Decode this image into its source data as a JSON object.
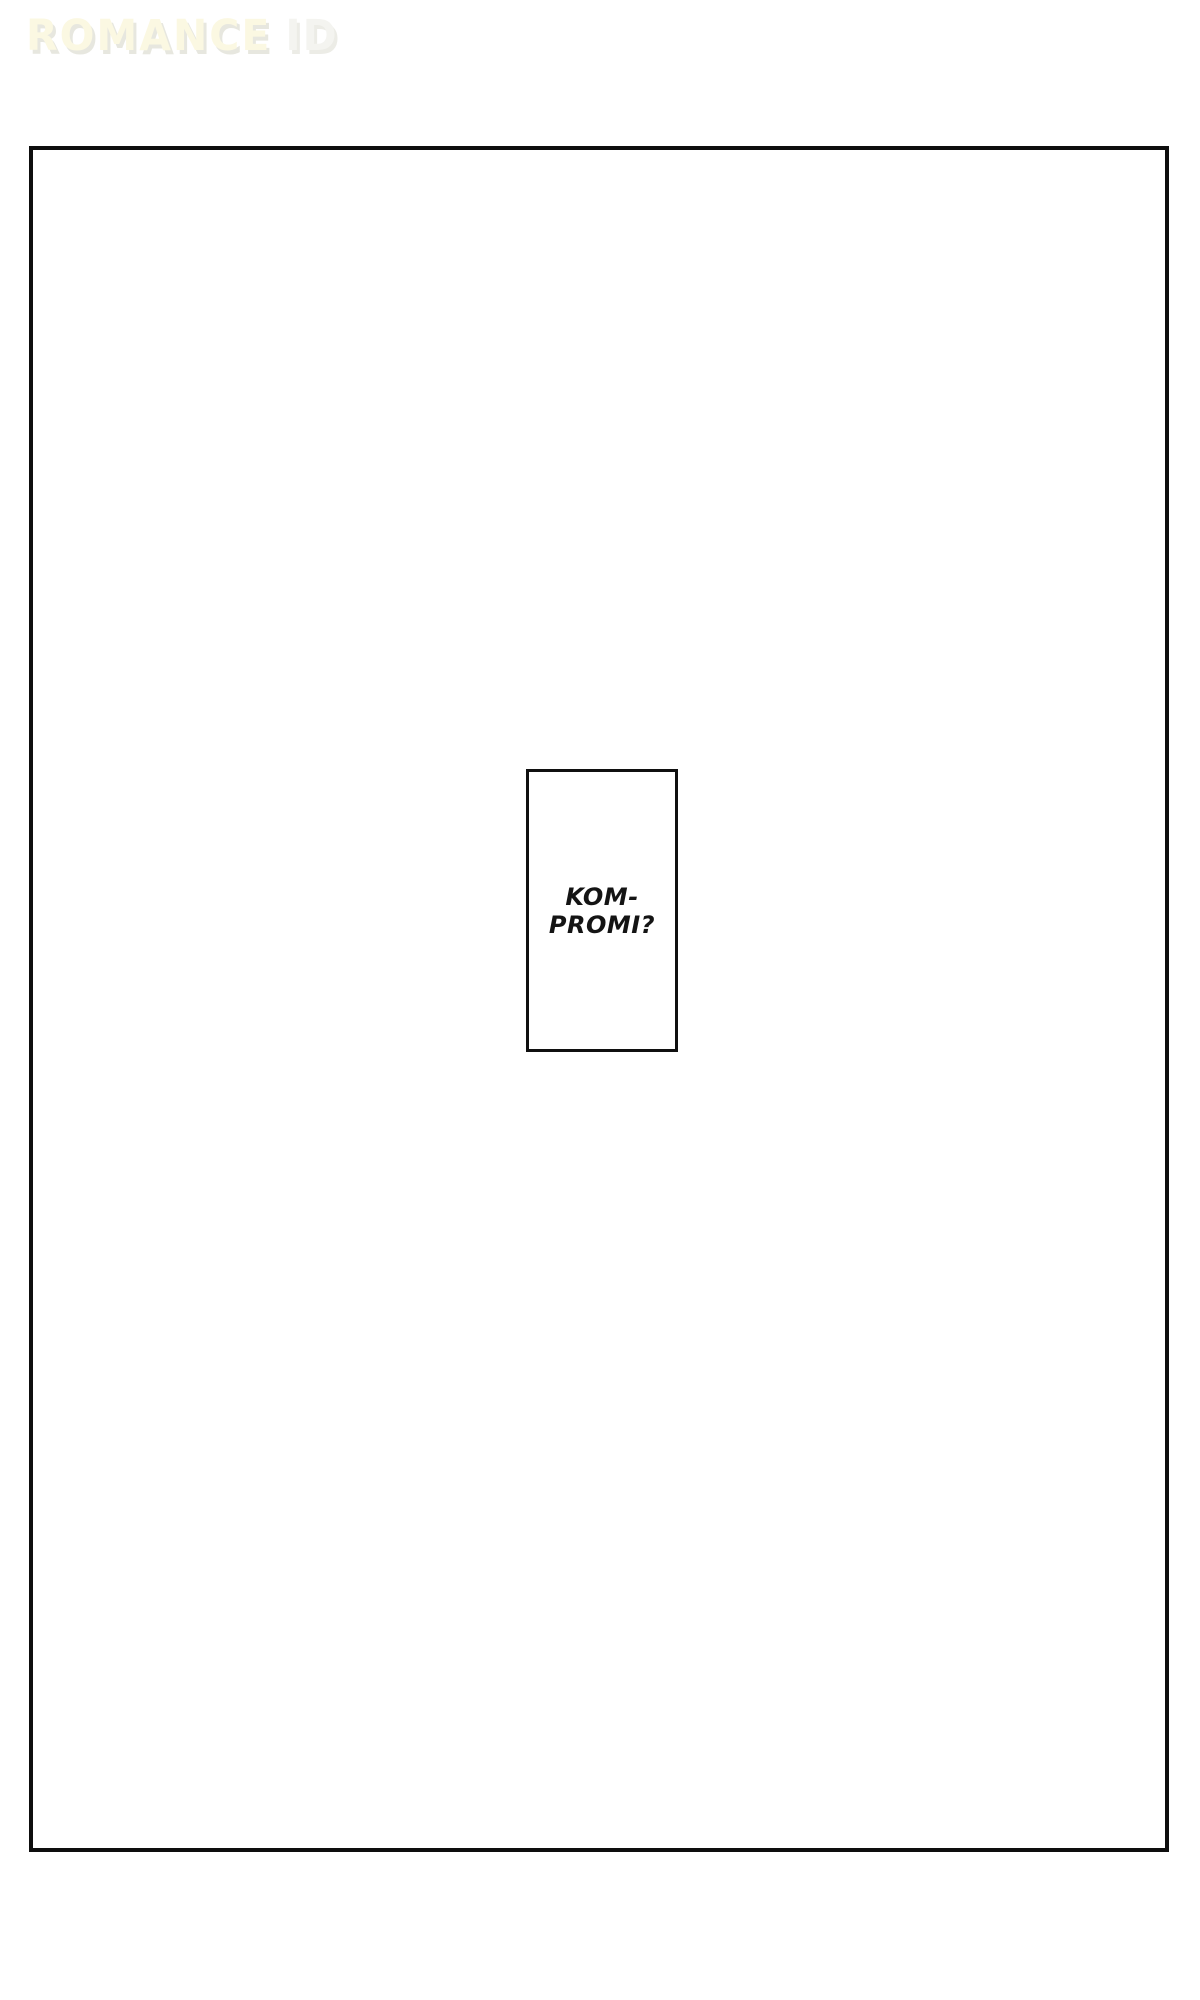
{
  "colors": {
    "page_bg": "#ffffff",
    "panel_border": "#0e0e0e",
    "speech_border": "#101010",
    "speech_text": "#141414",
    "watermark_primary": "#fbf8e2",
    "watermark_secondary": "#f4f4f0",
    "watermark_shadow": "#e7e7df",
    "watermark_shadow2": "#ecece6"
  },
  "watermark": {
    "text_primary": "ROMANCE",
    "text_secondary": "ID"
  },
  "speech_box": {
    "line1": "KOM-",
    "line2": "PROMI?"
  }
}
